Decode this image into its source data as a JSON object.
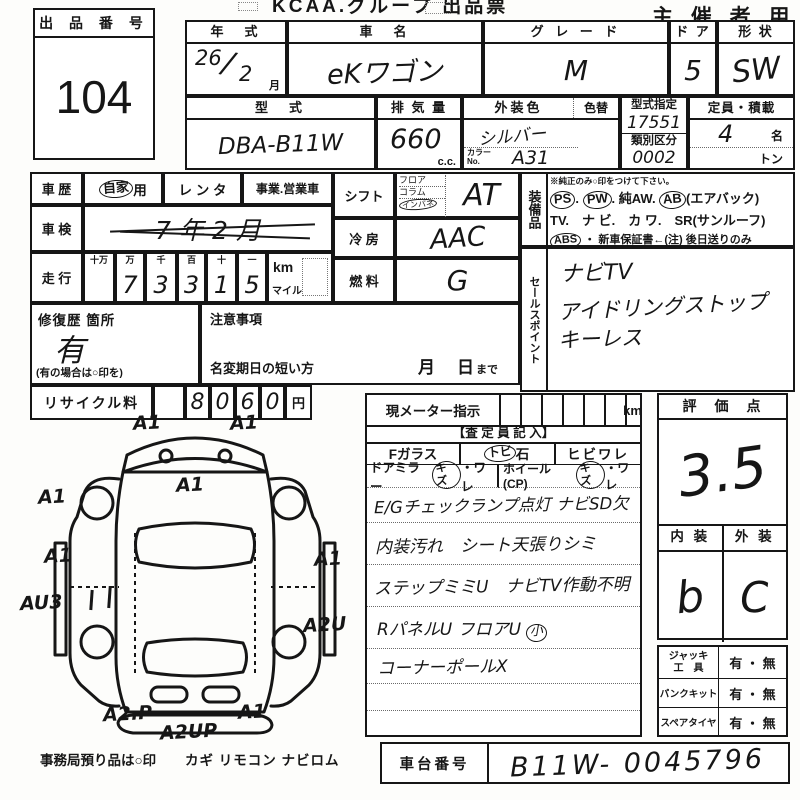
{
  "header": {
    "title": "KCAA.グループ 出品票",
    "audience": "主 催 者 用",
    "lot": {
      "label": "出 品 番 号",
      "number": "104"
    }
  },
  "info": {
    "year": {
      "label": "年　式",
      "value_year": "26",
      "value_month": "2",
      "unit": "月"
    },
    "name": {
      "label": "車　名",
      "value": "eKワゴン"
    },
    "grade": {
      "label": "グ レ ー ド",
      "value": "M"
    },
    "doors": {
      "label": "ド ア",
      "value": "5"
    },
    "shape": {
      "label": "形 状",
      "value": "SW"
    },
    "model": {
      "label": "型　式",
      "value": "DBA-B11W"
    },
    "disp": {
      "label": "排 気 量",
      "value": "660",
      "unit": "c.c."
    },
    "color": {
      "label": "外装色",
      "change_label": "色替",
      "value": "シルバー",
      "code_label": "カラーNo.",
      "code_value": "A31"
    },
    "type_designation": {
      "label": "型式指定",
      "value": "17551"
    },
    "classification": {
      "label": "類別区分",
      "value": "0002"
    },
    "capacity": {
      "label": "定員・積載",
      "persons": "4",
      "persons_unit": "名",
      "load_unit": "トン"
    }
  },
  "history": {
    "label": "車 歴",
    "private_circled": "自家",
    "private_suffix": "用",
    "rental": "レ ン タ",
    "business": "事業.営業車"
  },
  "shaken": {
    "label": "車 検",
    "value": "7 年 2 月"
  },
  "mileage": {
    "label": "走 行",
    "headers": [
      "十万",
      "万",
      "千",
      "百",
      "十",
      "一"
    ],
    "digits": [
      "",
      "7",
      "3",
      "3",
      "1",
      "5"
    ],
    "unit_km": "km",
    "unit_mile": "マイル"
  },
  "shift": {
    "label": "シフト",
    "opt1": "フロア",
    "opt2": "コラム",
    "opt3": "インパネ",
    "value": "AT"
  },
  "cooling": {
    "label": "冷 房",
    "value": "AAC"
  },
  "fuel": {
    "label": "燃 料",
    "value": "G"
  },
  "repair": {
    "label": "修復歴 箇所",
    "value": "有",
    "note": "(有の場合は○印を)"
  },
  "caution": {
    "label": "注意事項"
  },
  "rename": {
    "label": "名変期日の短い方",
    "month": "月",
    "day": "日",
    "made": "まで"
  },
  "equipment": {
    "label": "装備品",
    "note": "※純正のみ○印をつけて下さい。",
    "ps": "PS",
    "pw": "PW",
    "aw": "純AW.",
    "ab": "AB",
    "ab_note": "(エアバック)",
    "line2": "TV.　ナ ビ.　カ ワ.　SR(サンルーフ)",
    "abs": "ABS",
    "line3_rest": "・ 新車保証書←(注) 後日送りのみ"
  },
  "sales_points": {
    "label": "セールスポイント",
    "lines": [
      "ナビTV",
      "アイドリングストップ",
      "キーレス"
    ]
  },
  "recycle": {
    "label": "リサイクル料",
    "digits": [
      "8",
      "0",
      "6",
      "0"
    ],
    "unit": "円"
  },
  "diagram": {
    "damage_labels": [
      "A1",
      "A1",
      "A1",
      "A1",
      "A1",
      "A1",
      "AU3",
      "A2U",
      "A2.P",
      "A2UP",
      "A1"
    ],
    "deposit_note": "事務局預り品は○印",
    "deposit_items": "カギ  リモコン  ナビロム"
  },
  "meter": {
    "label": "現メーター指示",
    "unit": "km",
    "inspector": "【査 定 員 記 入】",
    "f_glass": "Fガラス",
    "tobi": "トビ",
    "stone": "石",
    "crack": "ヒビワレ",
    "door_mirror": "ドアミラー",
    "kizu1": "キズ",
    "ware1": "・ワレ",
    "wheel": "ホイール(CP)",
    "kizu2": "キズ",
    "ware2": "・ワレ",
    "note1": "E/Gチェックランプ点灯 ナビSD欠",
    "note2": "内装汚れ　シート天張りシミ",
    "note3": "ステップミミU　ナビTV作動不明",
    "note4": "RパネルU フロアU",
    "note4_circled": "小",
    "note5": "コーナーポールX"
  },
  "rating": {
    "label": "評　価　点",
    "value": "3.5",
    "interior_label": "内 装",
    "exterior_label": "外 装",
    "interior": "b",
    "exterior": "C"
  },
  "tools": {
    "jack_label1": "ジャッキ",
    "jack_label2": "工　具",
    "jack_value": "有 ・ 無",
    "puncture_label": "パンクキット",
    "puncture_value": "有 ・ 無",
    "spare_label": "スペアタイヤ",
    "spare_value": "有 ・ 無"
  },
  "chassis": {
    "label": "車台番号",
    "value": "B11W- 0045796"
  }
}
